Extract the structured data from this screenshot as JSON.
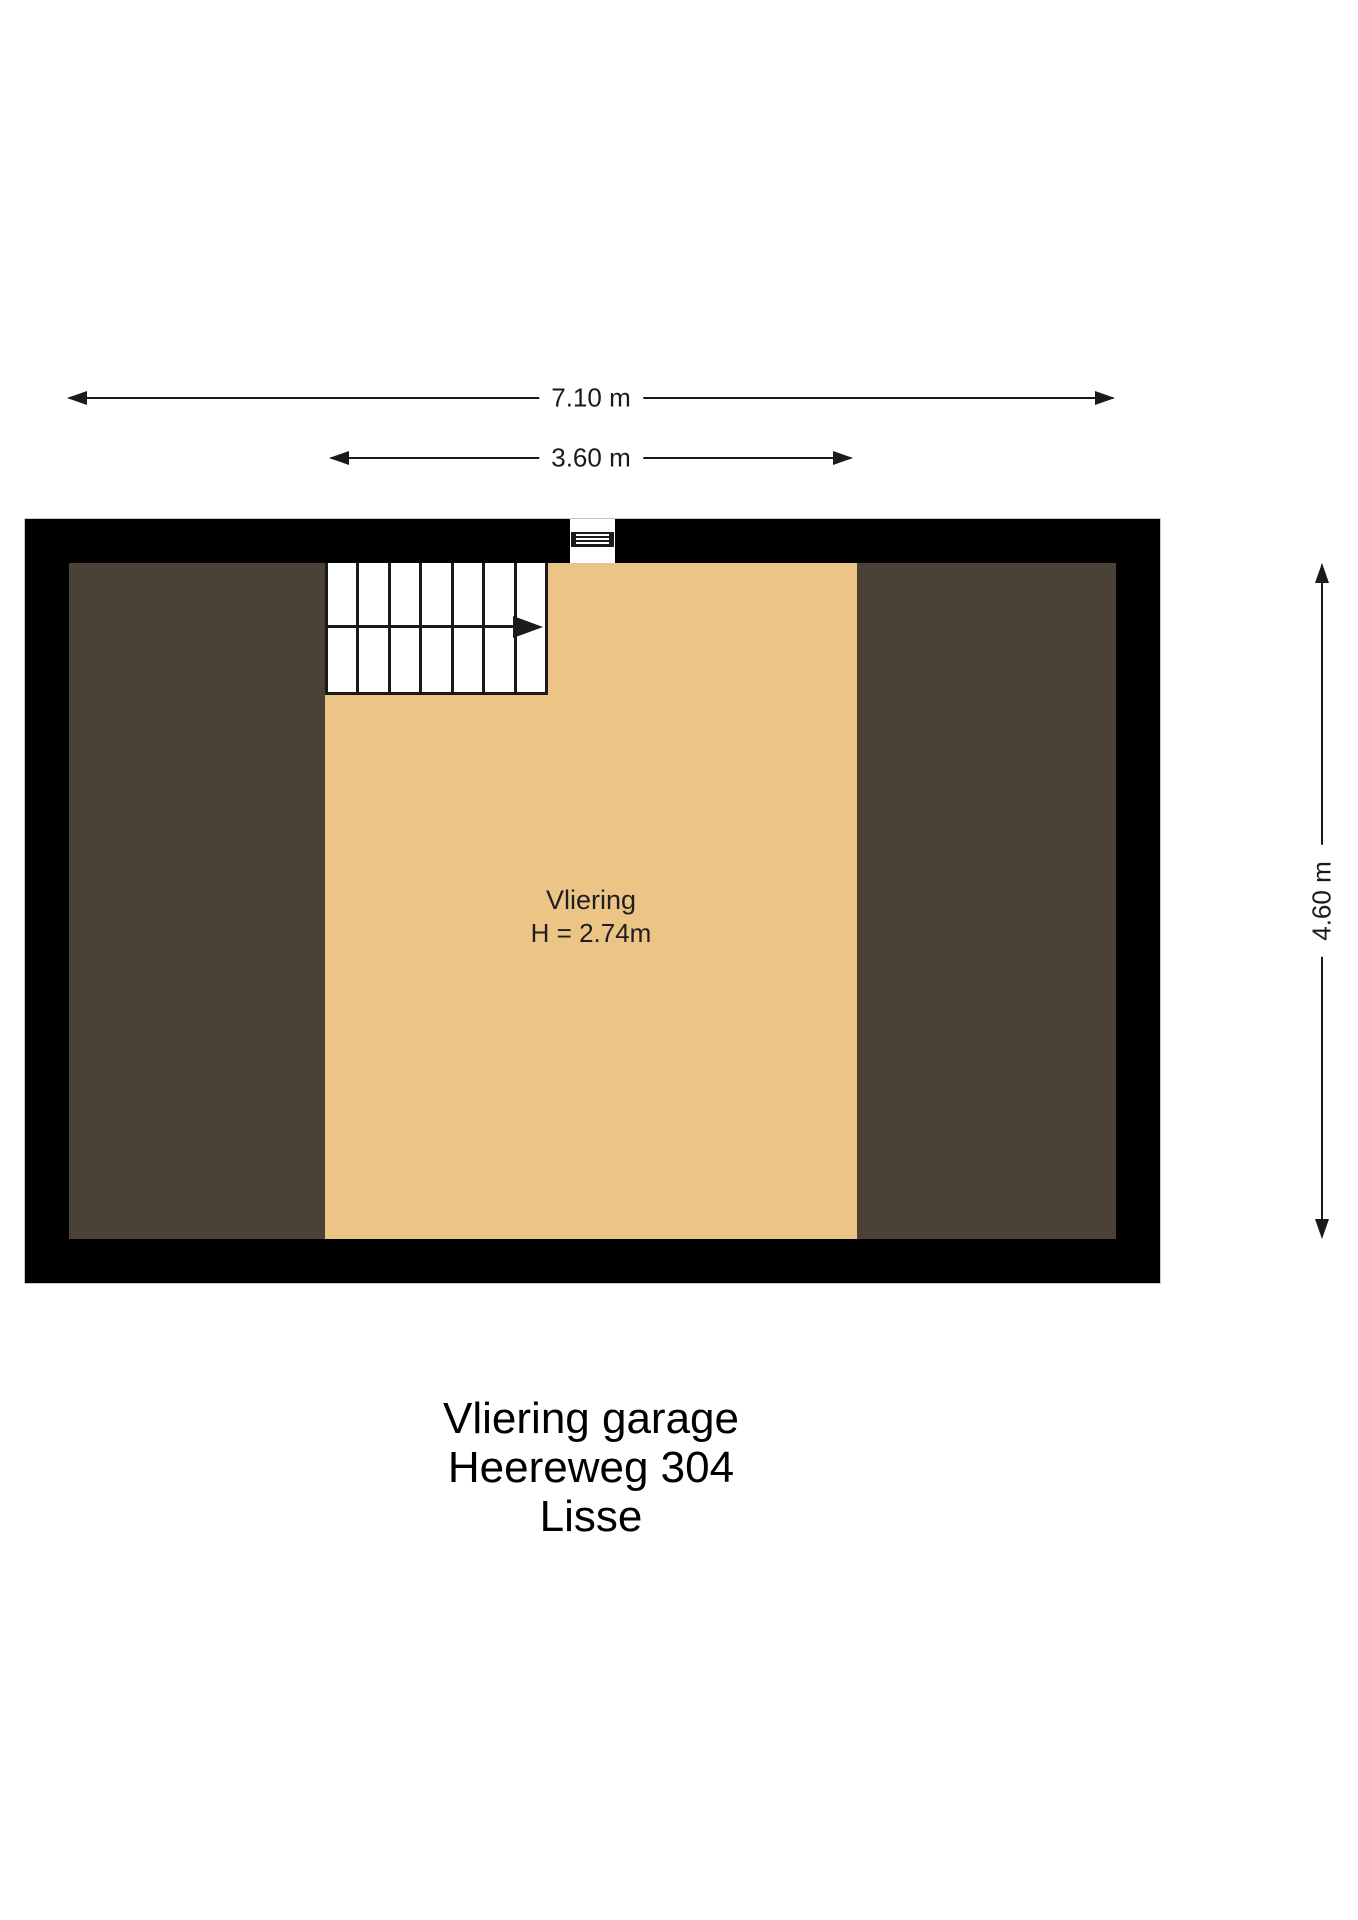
{
  "dimensions": {
    "top_width": {
      "label": "7.10 m"
    },
    "inner_width": {
      "label": "3.60 m"
    },
    "side_height": {
      "label": "4.60 m"
    }
  },
  "room": {
    "name": "Vliering",
    "height_note": "H = 2.74m"
  },
  "stairs": {
    "treads": 7
  },
  "title": {
    "line1": "Vliering garage",
    "line2": "Heereweg 304",
    "line3": "Lisse"
  },
  "colors": {
    "wall": "#000000",
    "floor-center": "#ecc486",
    "floor-side": "#4a4237",
    "line": "#1a1a1a",
    "text": "#1a1a1a"
  }
}
